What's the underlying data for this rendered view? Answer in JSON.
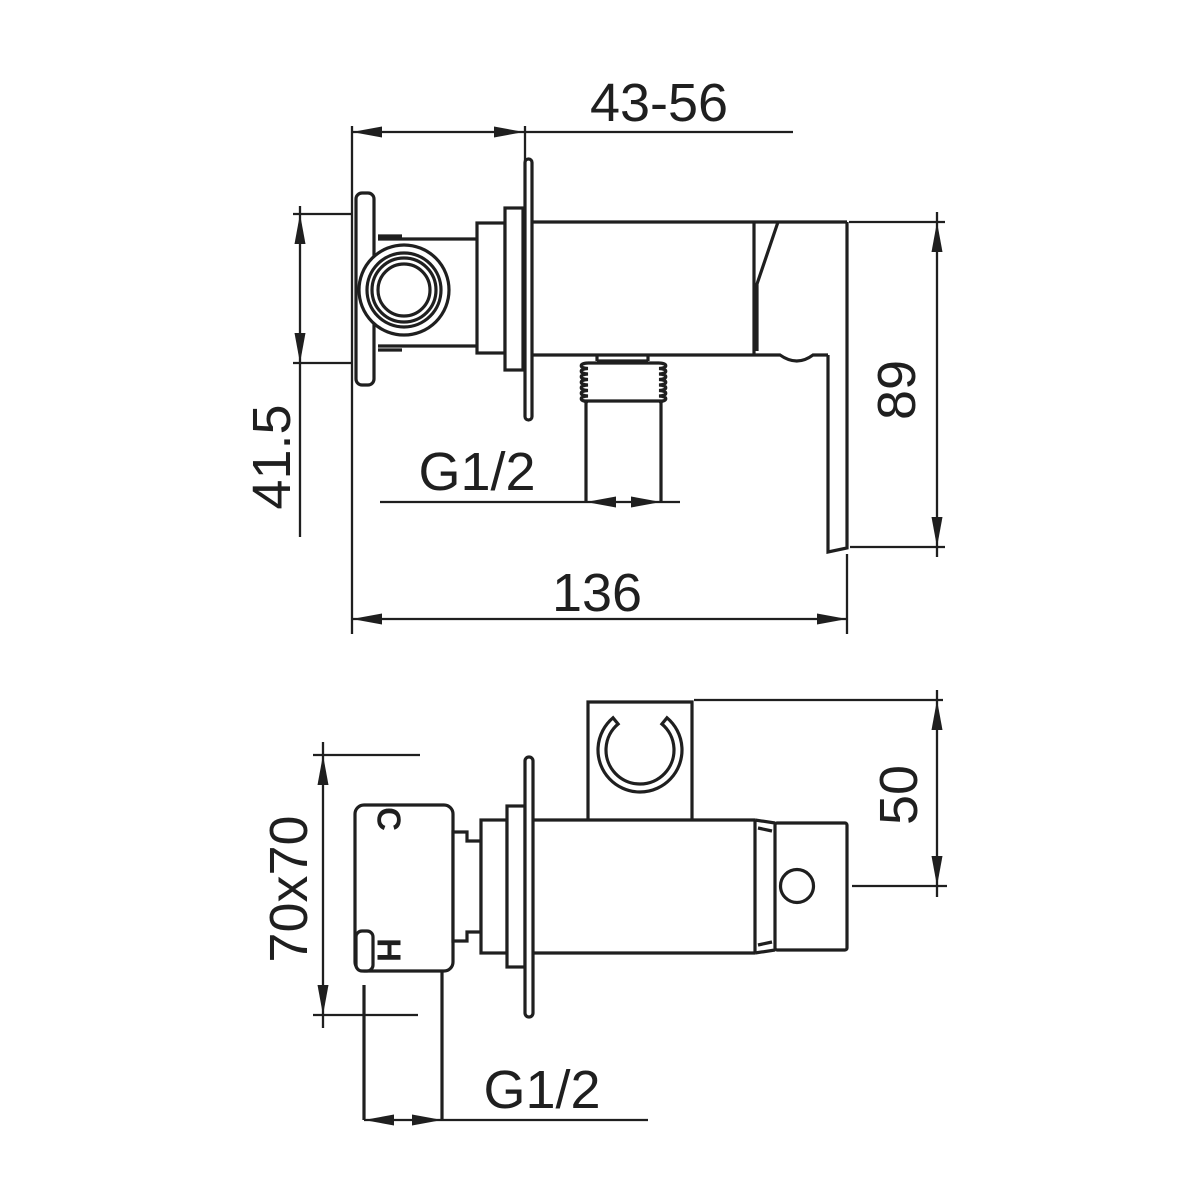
{
  "page": {
    "background": "#ffffff",
    "line_color": "#1f1f1f",
    "drawing_kind": "bidet shower mixer technical dimension drawing"
  },
  "drawing": {
    "side_view": {
      "dims": {
        "depth_range": "43-56",
        "inlet_center_height": "41.5",
        "outlet_thread": "G1/2",
        "overall_length": "136",
        "body_handle_height": "89"
      }
    },
    "plan_view": {
      "dims": {
        "wall_plate_size": "70x70",
        "holder_offset": "50",
        "inlet_thread": "G1/2"
      },
      "ports": {
        "cold": "C",
        "hot": "H"
      }
    }
  }
}
